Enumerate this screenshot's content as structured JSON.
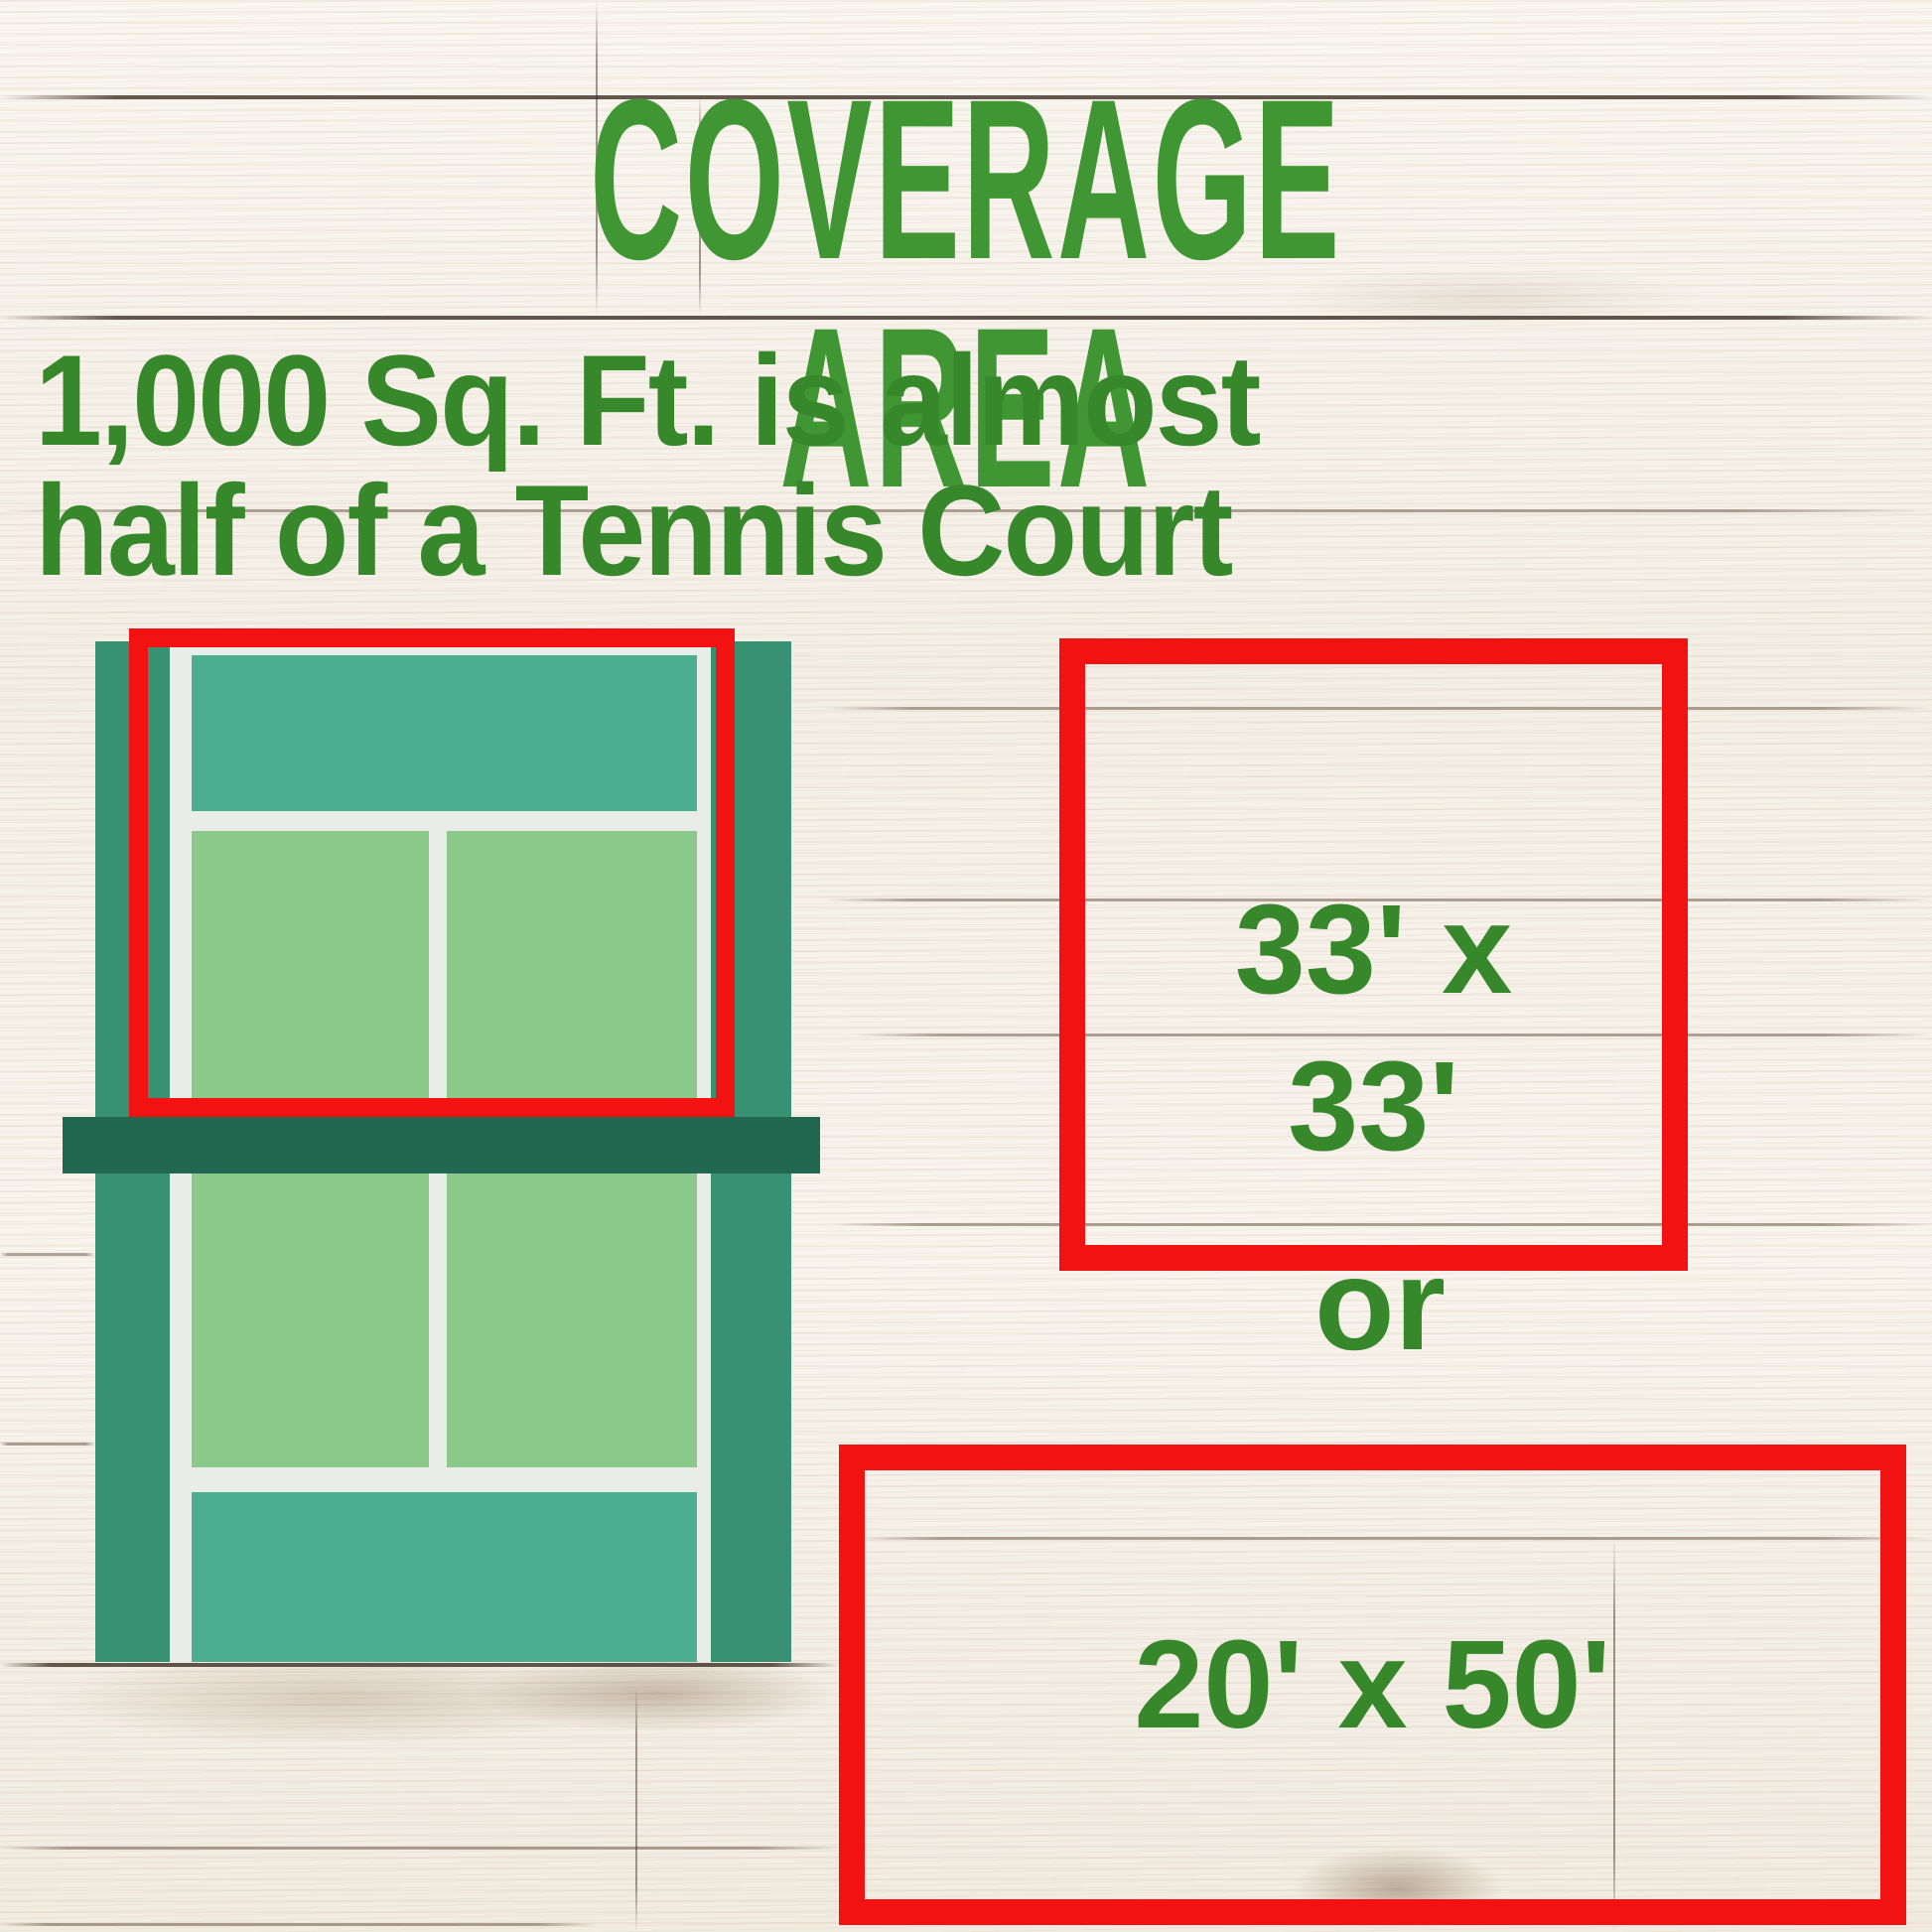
{
  "title": "COVERAGE AREA",
  "subtitle": {
    "line1": "1,000 Sq. Ft. is almost",
    "line2": "half of a Tennis Court"
  },
  "options": {
    "square": {
      "line1": "33' x",
      "line2": "33'"
    },
    "connector": "or",
    "rectangle": {
      "label": "20' x 50'"
    }
  },
  "icons": {
    "tennis_court": "tennis-court-illustration",
    "coverage_highlight": "red-outline-rectangle"
  },
  "colors": {
    "title_green": "#3f9633",
    "text_green": "#37872b",
    "highlight_red": "#f21212",
    "court_margin_teal": "#389172",
    "court_backcourt_teal": "#4bae8e",
    "court_service_green": "#8bc98b",
    "court_net_green": "#226850",
    "court_line_white": "#e9ede9",
    "background_wood_white": "#f6f1e8"
  }
}
